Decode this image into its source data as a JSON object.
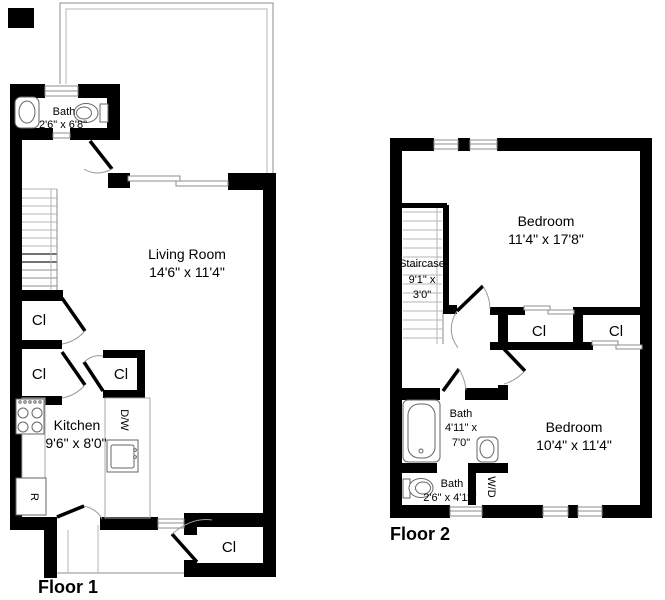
{
  "colors": {
    "wall": "#000000",
    "thin_line": "#8c8c8c",
    "background": "#ffffff",
    "text": "#000000"
  },
  "floor1": {
    "title": "Floor 1",
    "living_room": {
      "name": "Living Room",
      "dims": "14'6\" x 11'4\""
    },
    "kitchen": {
      "name": "Kitchen",
      "dims": "9'6\" x 8'0\""
    },
    "bath": {
      "name": "Bath",
      "dims": "2'6\" x 6'8\""
    },
    "closets": [
      "Cl",
      "Cl",
      "Cl",
      "Cl"
    ],
    "appliances": {
      "dishwasher": "D/W",
      "refrigerator": "R"
    },
    "fixtures": [
      "sink",
      "toilet",
      "stove",
      "kitchen-sink",
      "staircase",
      "patio",
      "sliding-door"
    ]
  },
  "floor2": {
    "title": "Floor 2",
    "bedroom_large": {
      "name": "Bedroom",
      "dims": "11'4\" x 17'8\""
    },
    "bedroom_small": {
      "name": "Bedroom",
      "dims": "10'4\" x 11'4\""
    },
    "staircase": {
      "name": "Staircase",
      "dims_line1": "9'1\" x",
      "dims_line2": "3'0\""
    },
    "bath_large": {
      "name": "Bath",
      "dims_line1": "4'11\" x",
      "dims_line2": "7'0\""
    },
    "bath_small": {
      "name": "Bath",
      "dims": "2'6\" x 4'11\""
    },
    "washer_dryer": "W/D",
    "closets": [
      "Cl",
      "Cl"
    ],
    "fixtures": [
      "bathtub",
      "sink",
      "toilet",
      "staircase"
    ]
  }
}
